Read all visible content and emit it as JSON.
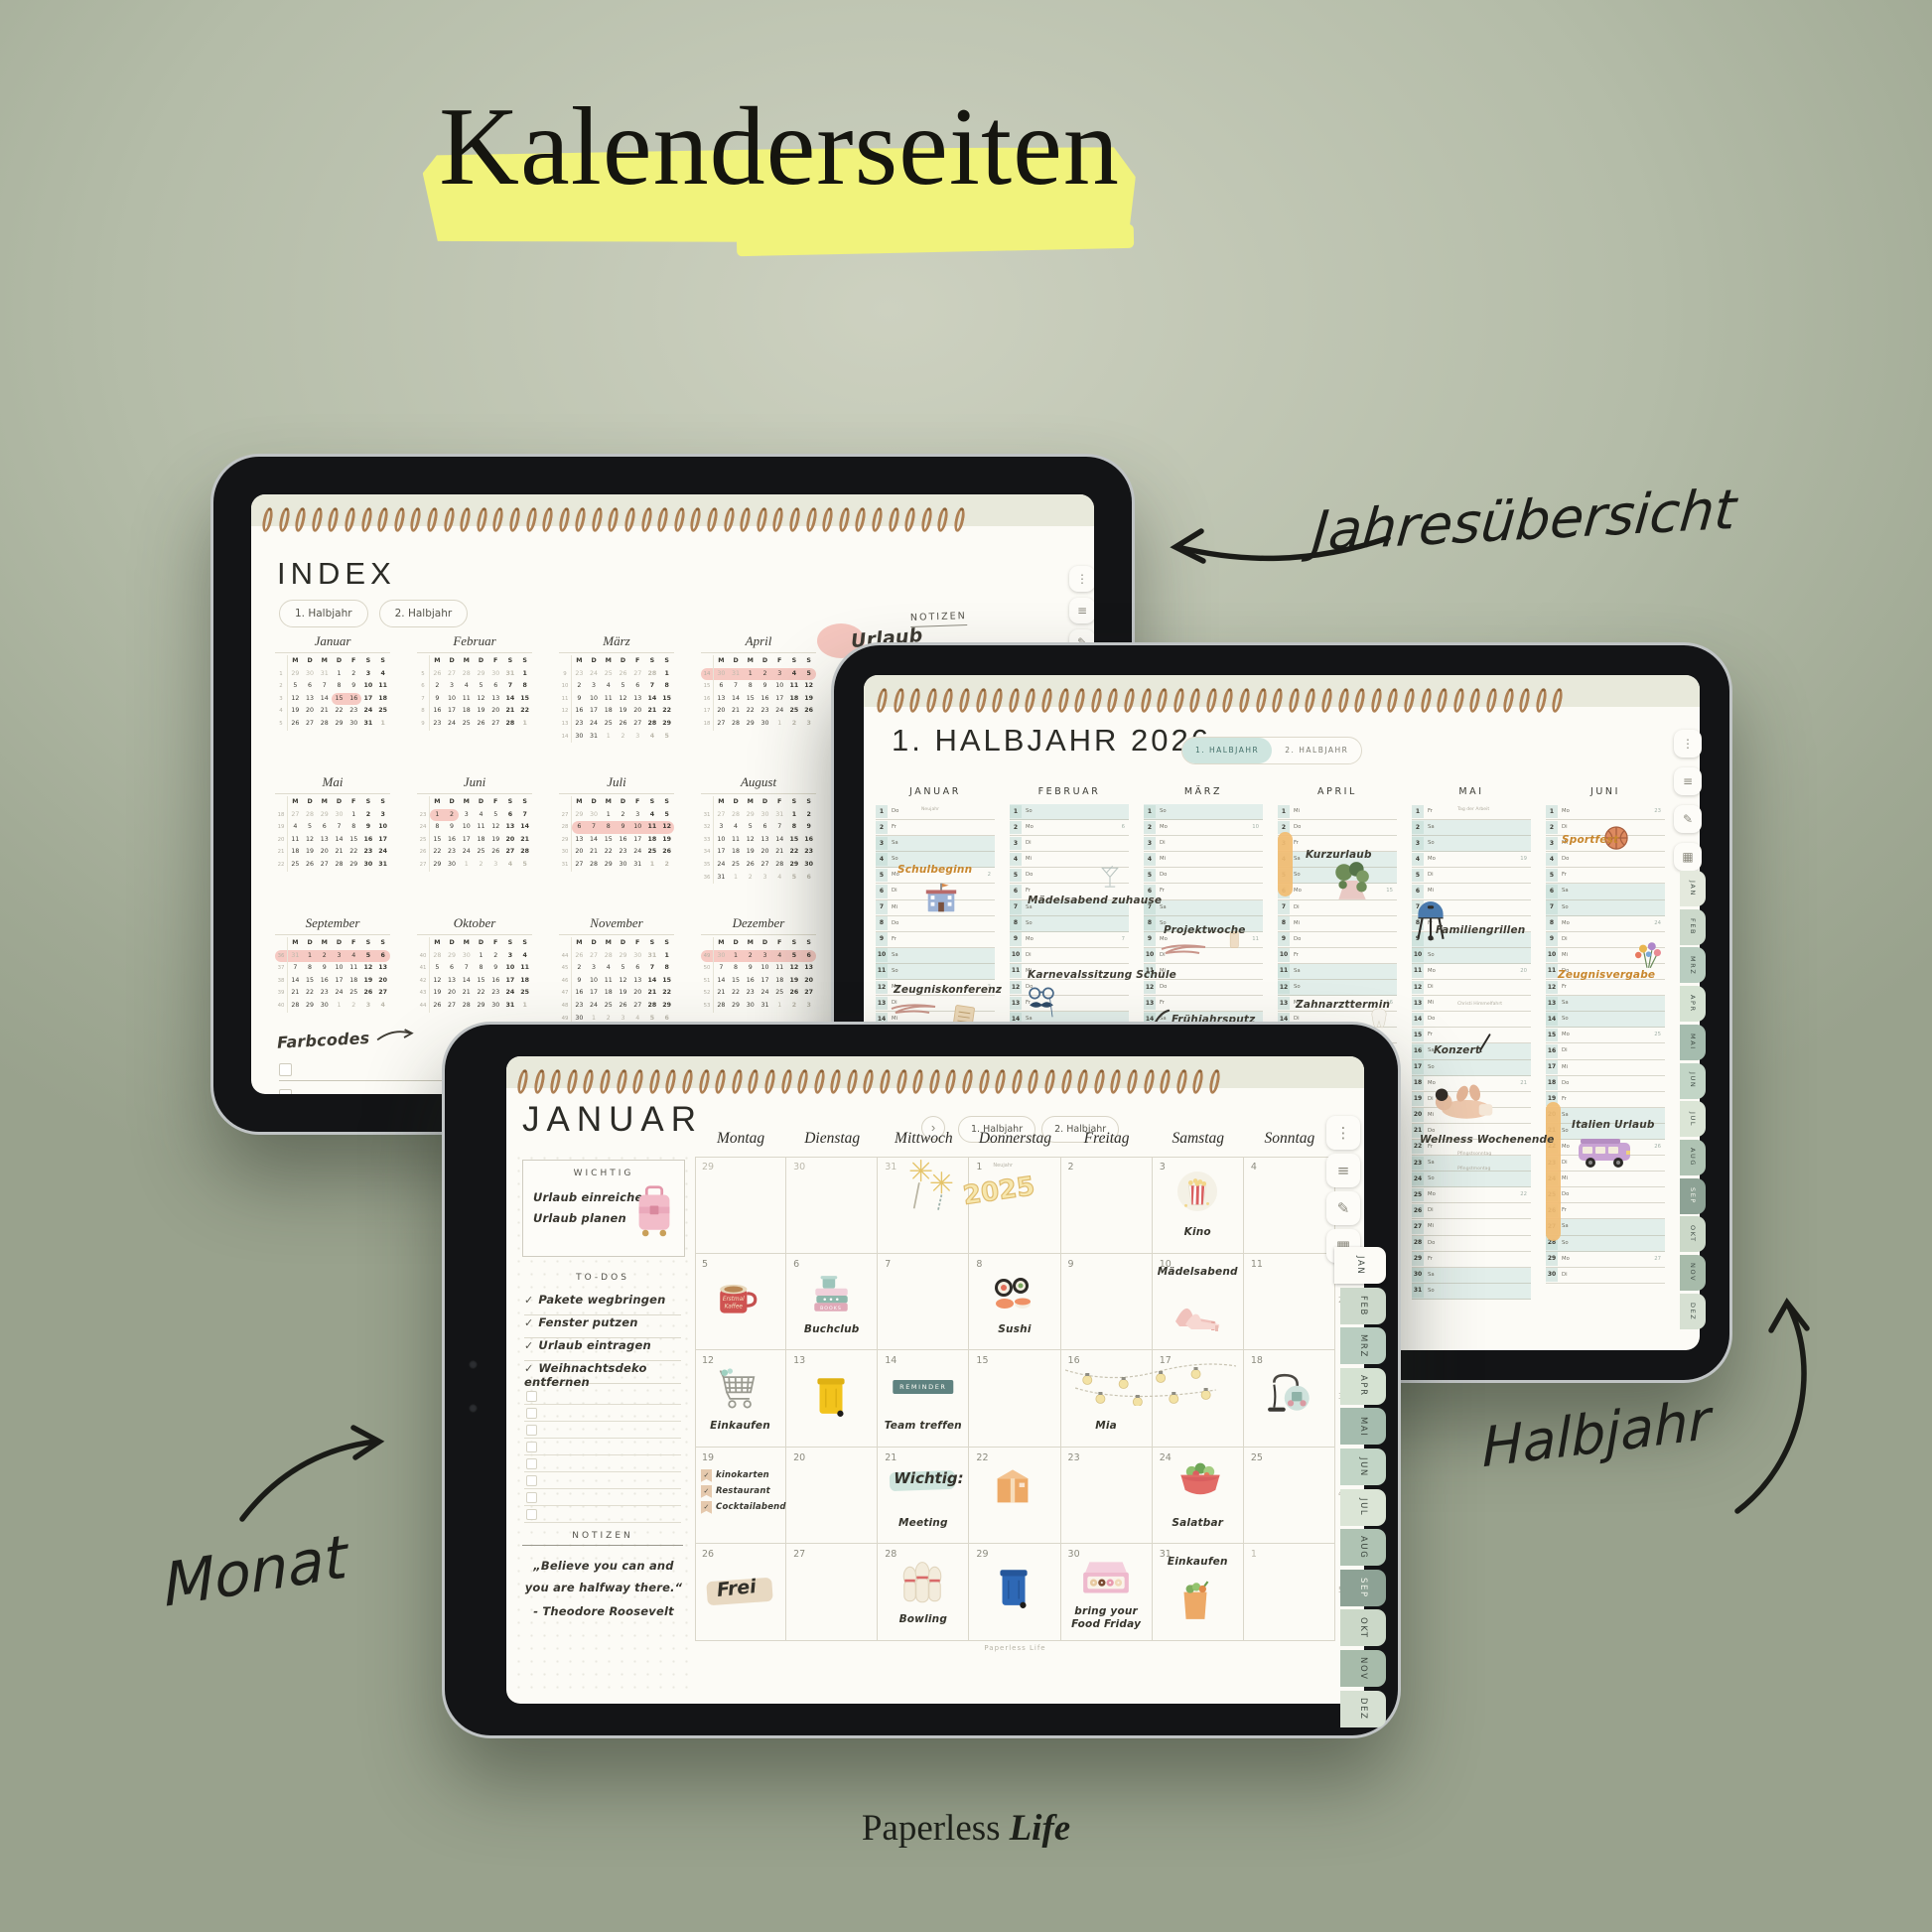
{
  "page": {
    "title": "Kalenderseiten",
    "footer_brand": "Paperless",
    "footer_accent": "Life"
  },
  "annotations": {
    "year_overview": "Jahresübersicht",
    "half_year": "Halbjahr",
    "month": "Monat"
  },
  "index_tablet": {
    "title": "INDEX",
    "tabs": [
      "1. Halbjahr",
      "2. Halbjahr"
    ],
    "day_headers": [
      "M",
      "D",
      "M",
      "D",
      "F",
      "S",
      "S"
    ],
    "year": 2026,
    "months": [
      "Januar",
      "Februar",
      "März",
      "April",
      "Mai",
      "Juni",
      "Juli",
      "August",
      "September",
      "Oktober",
      "November",
      "Dezember"
    ],
    "highlights": [
      {
        "month": 1,
        "from": 15,
        "to": 16
      },
      {
        "month": 4,
        "first_week": true
      },
      {
        "month": 6,
        "from": 1,
        "to": 2
      },
      {
        "month": 7,
        "from": 6,
        "to": 12
      },
      {
        "month": 9,
        "first_week": true
      },
      {
        "month": 12,
        "first_week": true
      }
    ],
    "notizen_label": "NOTIZEN",
    "notizen_note": "Urlaub",
    "farbcodes_label": "Farbcodes",
    "toolbar_icons": [
      "more-icon",
      "list-icon",
      "pen-icon"
    ]
  },
  "halbjahr_tablet": {
    "title": "1. HALBJAHR 2026",
    "tabs": [
      "1. HALBJAHR",
      "2. HALBJAHR"
    ],
    "active_tab": 0,
    "year": 2026,
    "month_headers": [
      "JANUAR",
      "FEBRUAR",
      "MÄRZ",
      "APRIL",
      "MAI",
      "JUNI"
    ],
    "weekday_abbr": [
      "So",
      "Mo",
      "Di",
      "Mi",
      "Do",
      "Fr",
      "Sa"
    ],
    "holiday_notes": [
      {
        "month": 1,
        "day": 1,
        "text": "Neujahr"
      },
      {
        "month": 5,
        "day": 1,
        "text": "Tag der Arbeit"
      },
      {
        "month": 5,
        "day": 14,
        "text": "Christi Himmelfahrt"
      },
      {
        "month": 5,
        "day": 24,
        "text": "Pfingstsonntag"
      },
      {
        "month": 5,
        "day": 25,
        "text": "Pfingstmontag"
      }
    ],
    "events": [
      {
        "month": 1,
        "day": 5,
        "label": "Schulbeginn",
        "style": "orange",
        "icon": "school"
      },
      {
        "month": 1,
        "day": 13,
        "label": "Zeugniskonferenz",
        "style": "dark",
        "icon": "document",
        "squiggle": true
      },
      {
        "month": 2,
        "day": 7,
        "label": "Mädelsabend zuhause",
        "style": "dark",
        "icon": "martini"
      },
      {
        "month": 2,
        "day": 12,
        "label": "Karnevalssitzung Schule",
        "style": "dark",
        "icon": "carnival-mask"
      },
      {
        "month": 3,
        "day": 9,
        "label": "Projektwoche",
        "style": "dark",
        "icon": "phone",
        "squiggle": true
      },
      {
        "month": 3,
        "day": 15,
        "label": "Frühjahrsputz",
        "style": "dark",
        "icon": "broom"
      },
      {
        "month": 4,
        "day": 4,
        "label": "Kurzurlaub",
        "style": "dark",
        "icon": "forest",
        "highlight_from": 3,
        "highlight_to": 6
      },
      {
        "month": 4,
        "day": 14,
        "label": "Zahnarzttermin",
        "style": "dark",
        "icon": "tooth"
      },
      {
        "month": 5,
        "day": 9,
        "label": "Familiengrillen",
        "style": "dark",
        "icon": "grill"
      },
      {
        "month": 5,
        "day": 17,
        "label": "Konzert",
        "style": "dark",
        "icon": "pen"
      },
      {
        "month": 5,
        "day": 23,
        "label": "Wellness Wochenende",
        "style": "dark",
        "icon": "massage"
      },
      {
        "month": 6,
        "day": 3,
        "label": "Sportfest",
        "style": "orange",
        "icon": "basketball"
      },
      {
        "month": 6,
        "day": 12,
        "label": "Zeugnisvergabe",
        "style": "orange",
        "icon": "flowers"
      },
      {
        "month": 6,
        "day": 22,
        "label": "Italien Urlaub",
        "style": "dark",
        "icon": "camper-van",
        "highlight_from": 21,
        "highlight_to": 29
      }
    ],
    "side_tabs": [
      "JAN",
      "FEB",
      "MRZ",
      "APR",
      "MAI",
      "JUN",
      "JUL",
      "AUG",
      "SEP",
      "OKT",
      "NOV",
      "DEZ"
    ],
    "toolbar_icons": [
      "more-icon",
      "list-icon",
      "pen-icon",
      "sticker-icon"
    ]
  },
  "monat_tablet": {
    "title": "JANUAR",
    "nav_next": "›",
    "tabs": [
      "1. Halbjahr",
      "2. Halbjahr"
    ],
    "weekdays": [
      "Montag",
      "Dienstag",
      "Mittwoch",
      "Donnerstag",
      "Freitag",
      "Samstag",
      "Sonntag"
    ],
    "week_numbers": [
      "1",
      "2",
      "3",
      "4",
      "5"
    ],
    "wichtig": {
      "label": "WICHTIG",
      "lines": [
        "Urlaub einreichen",
        "Urlaub planen"
      ]
    },
    "todos": {
      "label": "TO-DOS",
      "items": [
        "Pakete wegbringen",
        "Fenster putzen",
        "Urlaub eintragen",
        "Weihnachtsdeko entfernen"
      ],
      "empty_rows": 8
    },
    "notizen": {
      "label": "NOTIZEN",
      "quote_line1": "„Believe you can and",
      "quote_line2": "you are halfway there.“",
      "author": "- Theodore Roosevelt"
    },
    "watermark": "Paperless Life",
    "side_tabs": [
      "JAN",
      "FEB",
      "MRZ",
      "APR",
      "MAI",
      "JUN",
      "JUL",
      "AUG",
      "SEP",
      "OKT",
      "NOV",
      "DEZ"
    ],
    "active_side_tab": 0,
    "toolbar_icons": [
      "more-icon",
      "list-icon",
      "pen-icon",
      "sticker-icon"
    ],
    "weeks": [
      [
        {
          "num": "29",
          "muted": true
        },
        {
          "num": "30",
          "muted": true
        },
        {
          "num": "31",
          "muted": true,
          "icon": "fireworks"
        },
        {
          "num": "1",
          "note": "Neujahr",
          "sticker_text": "2025"
        },
        {
          "num": "2"
        },
        {
          "num": "3",
          "icon": "popcorn",
          "label": "Kino"
        },
        {
          "num": "4"
        }
      ],
      [
        {
          "num": "5",
          "icon": "coffee-mug",
          "icon_text": [
            "Erstmal",
            "Kaffee"
          ]
        },
        {
          "num": "6",
          "icon": "book-stack",
          "icon_text": [
            "BOOKS"
          ],
          "label": "Buchclub"
        },
        {
          "num": "7"
        },
        {
          "num": "8",
          "icon": "sushi",
          "label": "Sushi"
        },
        {
          "num": "9"
        },
        {
          "num": "10",
          "icon": "high-heels",
          "label": "Mädelsabend",
          "label_pos": "top"
        },
        {
          "num": "11"
        }
      ],
      [
        {
          "num": "12",
          "icon": "shopping-cart",
          "label": "Einkaufen"
        },
        {
          "num": "13",
          "icon": "trash-bin-yellow"
        },
        {
          "num": "14",
          "badge": "REMINDER",
          "label": "Team treffen"
        },
        {
          "num": "15"
        },
        {
          "num": "16",
          "icon": "string-lights",
          "label": "Mia"
        },
        {
          "num": "17"
        },
        {
          "num": "18",
          "icon": "vacuum-cleaner"
        }
      ],
      [
        {
          "num": "19",
          "checklist": [
            "kinokarten",
            "Restaurant",
            "Cocktailabend"
          ]
        },
        {
          "num": "20"
        },
        {
          "num": "21",
          "script": "Wichtig:",
          "label": "Meeting"
        },
        {
          "num": "22",
          "icon": "parcel-box"
        },
        {
          "num": "23"
        },
        {
          "num": "24",
          "icon": "salad-bowl",
          "label": "Salatbar"
        },
        {
          "num": "25"
        }
      ],
      [
        {
          "num": "26",
          "script_swipe": "Frei"
        },
        {
          "num": "27"
        },
        {
          "num": "28",
          "icon": "bowling-pins",
          "label": "Bowling"
        },
        {
          "num": "29",
          "icon": "trash-bin-blue"
        },
        {
          "num": "30",
          "icon": "donut-box",
          "label": "bring your Food Friday"
        },
        {
          "num": "31",
          "icon": "grocery-bag",
          "label": "Einkaufen",
          "label_pos": "top"
        },
        {
          "num": "1",
          "muted": true
        }
      ]
    ]
  }
}
